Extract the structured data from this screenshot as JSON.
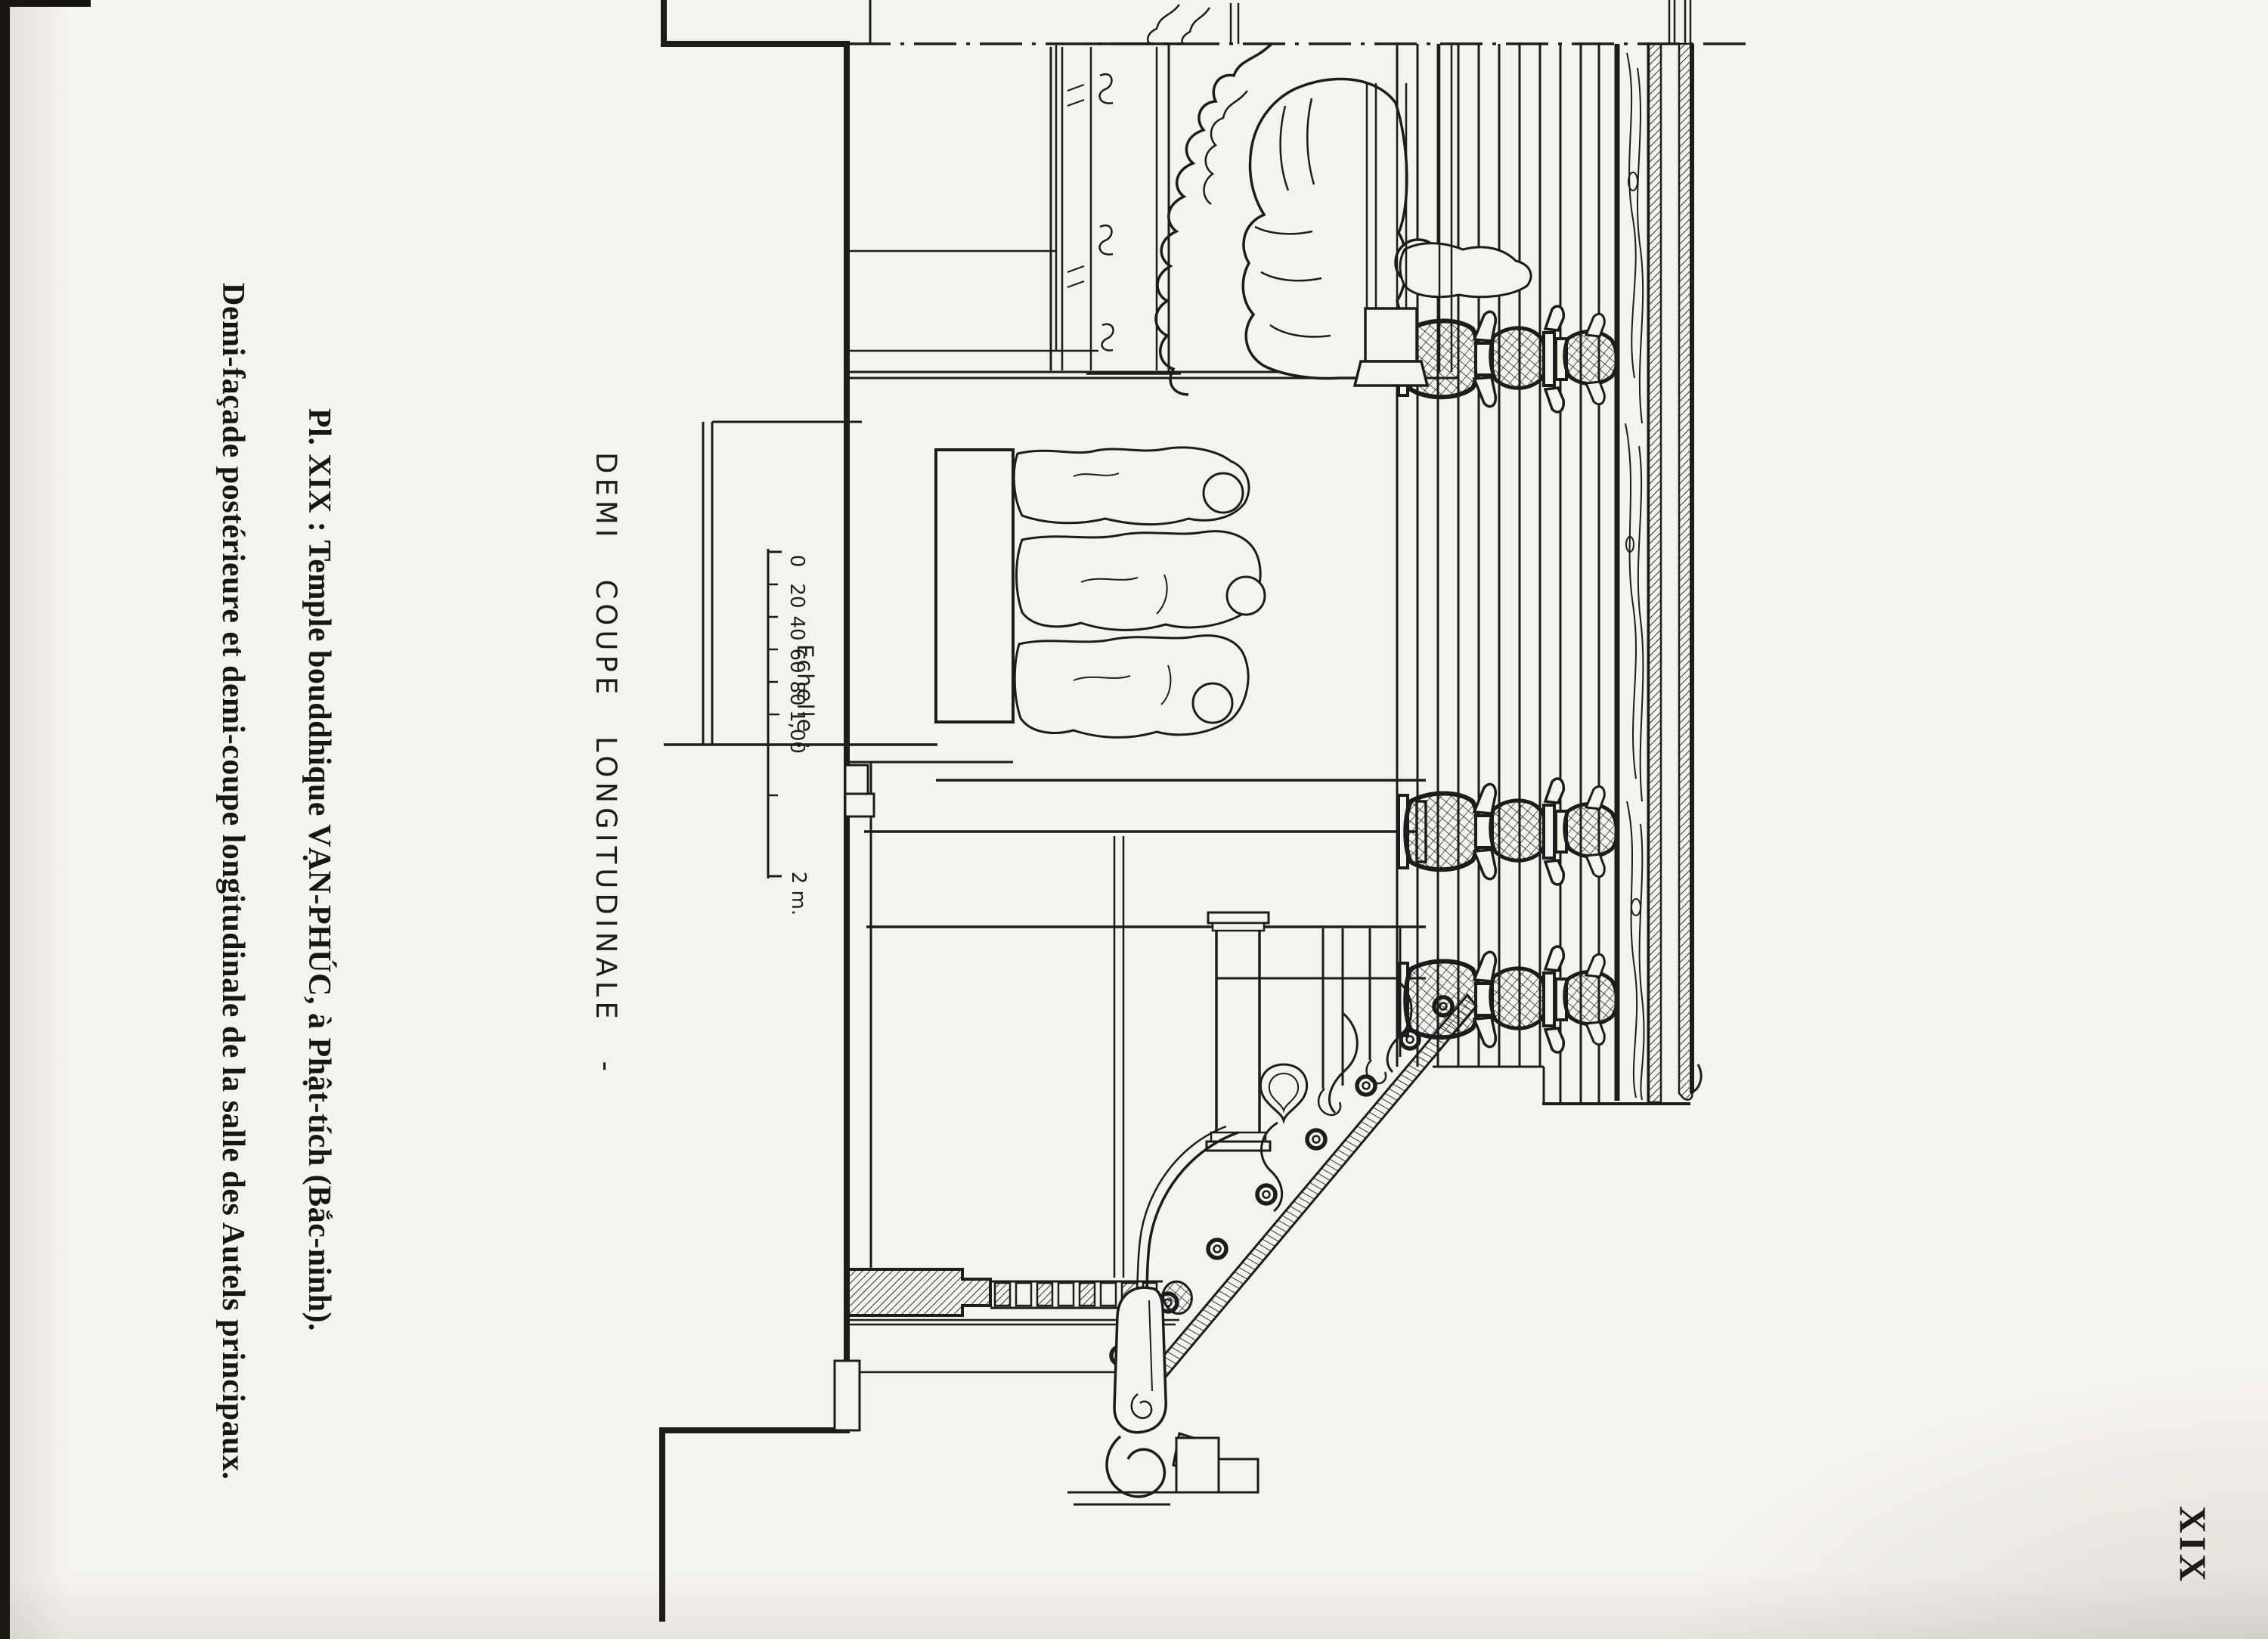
{
  "page": {
    "plate_number": "XIX"
  },
  "caption": {
    "line1": "Pl. XIX : Temple bouddhique VẠN-PHÚC, à Phật-tích (Bắc-ninh).",
    "line2": "Demi-façade postérieure et demi-coupe longitudinale de la salle des Autels principaux."
  },
  "drawing_label": {
    "title": "DEMI COUPE LONGITUDINALE -"
  },
  "scale": {
    "label": "Echelle :",
    "tick_labels": [
      "0",
      "20",
      "40",
      "60",
      "80",
      "1,00"
    ],
    "end_label": "2 m."
  },
  "colors": {
    "paper": "#f5f3ee",
    "ink": "#1c1c1c"
  }
}
